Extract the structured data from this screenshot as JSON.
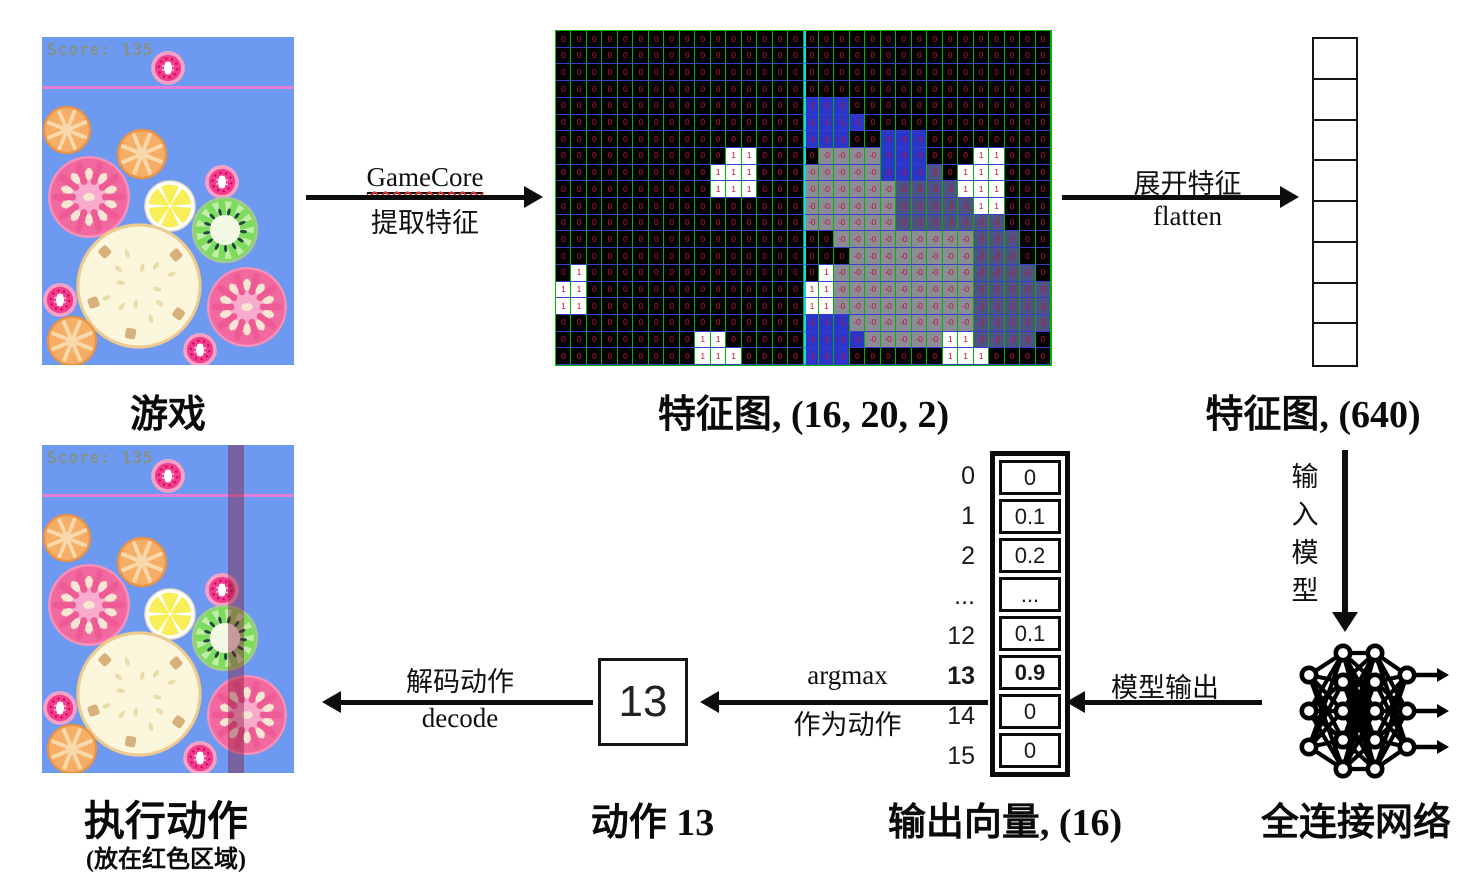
{
  "colors": {
    "game_bg": "#6d99f0",
    "top_line": "#e77cd9",
    "score_text": "#8d8f63",
    "action_strip": "rgba(135,25,55,0.42)",
    "grid_line_vertical": "#00b400",
    "grid_line_horizontal": "#3240cc",
    "channel_divider": "#22d4de",
    "cell_text": "#c41430",
    "cell_blue": "#2b35c8",
    "cell_gray": "#8c8c96",
    "cell_dark": "#4e5284"
  },
  "game": {
    "score": "Score: 135",
    "fruits": [
      {
        "type": "berry",
        "cx": 126,
        "cy": 31,
        "r": 17
      },
      {
        "type": "orange",
        "cx": 25,
        "cy": 93,
        "r": 24
      },
      {
        "type": "orange",
        "cx": 100,
        "cy": 117,
        "r": 25
      },
      {
        "type": "tomato",
        "cx": 47,
        "cy": 160,
        "r": 41
      },
      {
        "type": "lemon",
        "cx": 128,
        "cy": 169,
        "r": 25
      },
      {
        "type": "berry",
        "cx": 180,
        "cy": 145,
        "r": 17
      },
      {
        "type": "kiwi",
        "cx": 183,
        "cy": 193,
        "r": 33
      },
      {
        "type": "pineapple",
        "cx": 97,
        "cy": 249,
        "r": 62
      },
      {
        "type": "berry",
        "cx": 18,
        "cy": 263,
        "r": 17
      },
      {
        "type": "orange",
        "cx": 30,
        "cy": 304,
        "r": 25
      },
      {
        "type": "tomato",
        "cx": 205,
        "cy": 270,
        "r": 40
      },
      {
        "type": "berry",
        "cx": 158,
        "cy": 313,
        "r": 17
      }
    ]
  },
  "captions": {
    "game": "游戏",
    "feature_map": "特征图, (16, 20, 2)",
    "flat": "特征图, (640)",
    "action": "动作 13",
    "output_vector": "输出向量, (16)",
    "network": "全连接网络",
    "execute": "执行动作",
    "execute_sub": "(放在红色区域)"
  },
  "arrows": {
    "extract": {
      "top": "GameCore",
      "bottom": "提取特征"
    },
    "flatten": {
      "top": "展开特征",
      "bottom": "flatten"
    },
    "input_model": {
      "label": "输入模型"
    },
    "model_output": {
      "label": "模型输出"
    },
    "argmax": {
      "top": "argmax",
      "bottom": "作为动作"
    },
    "decode": {
      "top": "解码动作",
      "bottom": "decode"
    }
  },
  "feature_map": {
    "shape": "(16, 20, 2)",
    "cell_text_map": {
      "0": "0",
      "1": "1",
      "b": "-1",
      "g": "-0",
      "d": "-2"
    },
    "rows": [
      "00000000000000000000000000000000",
      "00000000000000000000000000000000",
      "00000000000000000000000000000000",
      "00000000000000000000000000000000",
      "0000000000000000bbb0000000000000",
      "0000000000000000bbbb000000000000",
      "0000000000000000bbb00bbb00000000",
      "00000000000110000ggggbbb00011000",
      "0000000000111000gggggbbbd0111000",
      "0000000000111000ggggggdddd111000",
      "0000000000000000ggggggddddd11000",
      "0000000000000000ggggggddddddd000",
      "000000000000000000gggggggggddd00",
      "0000000000000000000ggggggggddd00",
      "010000000000000001gggggggggdddd0",
      "110000000000000011gggggggggddddd",
      "110000000000000011gggggggggddddd",
      "0000000000000000bbbggggggggddddd",
      "0000000001100000bbbbggggg11dddd0",
      "0000000001110000bbb0000001110000"
    ]
  },
  "flat_vector": {
    "cells": 8,
    "shape": "(640)"
  },
  "output_vector": {
    "shape": "(16)",
    "rows": [
      {
        "index": "0",
        "value": "0",
        "bold": false
      },
      {
        "index": "1",
        "value": "0.1",
        "bold": false
      },
      {
        "index": "2",
        "value": "0.2",
        "bold": false
      },
      {
        "index": "...",
        "value": "...",
        "bold": false
      },
      {
        "index": "12",
        "value": "0.1",
        "bold": false
      },
      {
        "index": "13",
        "value": "0.9",
        "bold": true
      },
      {
        "index": "14",
        "value": "0",
        "bold": false
      },
      {
        "index": "15",
        "value": "0",
        "bold": false
      }
    ]
  },
  "action_box": {
    "value": "13"
  },
  "network": {
    "layers": [
      3,
      5,
      5,
      3
    ]
  }
}
